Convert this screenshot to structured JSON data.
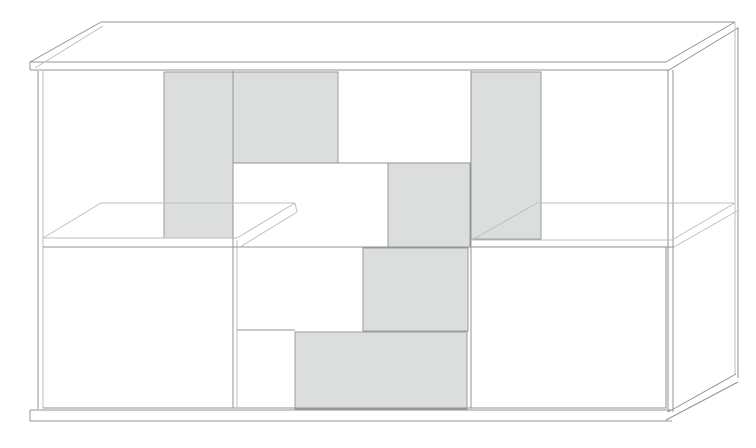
{
  "illustration": {
    "subject": "sideboard-cabinet-line-drawing",
    "style": "hidden-line technical render, white and gray patchwork door fronts"
  },
  "palette": {
    "background": "#ffffff",
    "panel_fill": "#dcdedd",
    "panel_border": "#989d9b",
    "line": "#8f9492",
    "line_light": "#bcc0be"
  },
  "drawing": {
    "width": 756,
    "height": 448,
    "top_surface": {
      "name": "top-slab-surface",
      "points": "30,62 666,62 735,22 101,22"
    },
    "panels": [
      {
        "name": "open-compartment-top-left",
        "x": 43,
        "y": 72,
        "w": 121,
        "h": 166,
        "fill": "none"
      },
      {
        "name": "glass-door-top-left",
        "x": 164,
        "y": 72,
        "w": 69,
        "h": 166,
        "fill": "gray"
      },
      {
        "name": "gray-door-top-center-left",
        "x": 233,
        "y": 72,
        "w": 105,
        "h": 91,
        "fill": "gray"
      },
      {
        "name": "white-door-top-center",
        "x": 338,
        "y": 72,
        "w": 133,
        "h": 91,
        "fill": "none"
      },
      {
        "name": "glass-door-top-right",
        "x": 471,
        "y": 72,
        "w": 70,
        "h": 167,
        "fill": "gray"
      },
      {
        "name": "open-compartment-top-right",
        "x": 541,
        "y": 72,
        "w": 124,
        "h": 168,
        "fill": "none"
      },
      {
        "name": "white-door-mid-center",
        "x": 233,
        "y": 163,
        "w": 155,
        "h": 84,
        "fill": "none"
      },
      {
        "name": "gray-door-mid-center-right",
        "x": 388,
        "y": 163,
        "w": 82,
        "h": 84,
        "fill": "gray"
      },
      {
        "name": "white-door-bottom-left",
        "x": 43,
        "y": 247,
        "w": 190,
        "h": 161,
        "fill": "none"
      },
      {
        "name": "white-door-center-upper",
        "x": 237,
        "y": 247,
        "w": 126,
        "h": 83,
        "fill": "none"
      },
      {
        "name": "white-door-center-small",
        "x": 237,
        "y": 330,
        "w": 58,
        "h": 78,
        "fill": "none"
      },
      {
        "name": "gray-door-center",
        "x": 363,
        "y": 248,
        "w": 105,
        "h": 83,
        "fill": "gray"
      },
      {
        "name": "gray-door-bottom-center",
        "x": 295,
        "y": 332,
        "w": 172,
        "h": 77,
        "fill": "gray"
      },
      {
        "name": "white-door-bottom-right",
        "x": 471,
        "y": 247,
        "w": 195,
        "h": 161,
        "fill": "none"
      }
    ],
    "lines": [
      {
        "name": "top-front-edge",
        "x1": 30,
        "y1": 62,
        "x2": 666,
        "y2": 62,
        "tone": "m"
      },
      {
        "name": "top-left-diagonal-outer",
        "x1": 30,
        "y1": 62,
        "x2": 101,
        "y2": 22,
        "tone": "m"
      },
      {
        "name": "top-left-diagonal-inner",
        "x1": 35,
        "y1": 68,
        "x2": 103,
        "y2": 26,
        "tone": "l"
      },
      {
        "name": "top-back-edge",
        "x1": 101,
        "y1": 22,
        "x2": 735,
        "y2": 22,
        "tone": "m"
      },
      {
        "name": "top-right-diagonal-outer",
        "x1": 666,
        "y1": 62,
        "x2": 735,
        "y2": 22,
        "tone": "m"
      },
      {
        "name": "top-slab-bottom-edge",
        "x1": 30,
        "y1": 70,
        "x2": 669,
        "y2": 70,
        "tone": "m"
      },
      {
        "name": "top-right-diagonal-inner",
        "x1": 669,
        "y1": 70,
        "x2": 738,
        "y2": 28,
        "tone": "m"
      },
      {
        "name": "top-slab-left-end",
        "x1": 30,
        "y1": 62,
        "x2": 30,
        "y2": 70,
        "tone": "m"
      },
      {
        "name": "back-right-vertical-inner",
        "x1": 735,
        "y1": 22,
        "x2": 735,
        "y2": 374,
        "tone": "l"
      },
      {
        "name": "back-right-vertical-outer",
        "x1": 738,
        "y1": 27,
        "x2": 738,
        "y2": 378,
        "tone": "m"
      },
      {
        "name": "side-bottom-diagonal",
        "x1": 668,
        "y1": 412,
        "x2": 736,
        "y2": 374,
        "tone": "m"
      },
      {
        "name": "plinth-right-diagonal",
        "x1": 666,
        "y1": 420,
        "x2": 738,
        "y2": 382,
        "tone": "m"
      },
      {
        "name": "front-right-vertical-inner",
        "x1": 668,
        "y1": 70,
        "x2": 668,
        "y2": 412,
        "tone": "m"
      },
      {
        "name": "front-right-vertical-outer",
        "x1": 673,
        "y1": 70,
        "x2": 673,
        "y2": 412,
        "tone": "m"
      },
      {
        "name": "left-vertical-outer",
        "x1": 38,
        "y1": 71,
        "x2": 38,
        "y2": 409,
        "tone": "m"
      },
      {
        "name": "left-vertical-inner",
        "x1": 43,
        "y1": 71,
        "x2": 43,
        "y2": 408,
        "tone": "l"
      },
      {
        "name": "plinth-top-edge",
        "x1": 30,
        "y1": 410,
        "x2": 672,
        "y2": 410,
        "tone": "m"
      },
      {
        "name": "plinth-bottom-edge",
        "x1": 30,
        "y1": 421,
        "x2": 672,
        "y2": 421,
        "tone": "m"
      },
      {
        "name": "plinth-left-end",
        "x1": 30,
        "y1": 410,
        "x2": 30,
        "y2": 421,
        "tone": "m"
      },
      {
        "name": "door-bottom-line",
        "x1": 43,
        "y1": 408,
        "x2": 666,
        "y2": 408,
        "tone": "m"
      },
      {
        "name": "divider-vertical-left",
        "x1": 233,
        "y1": 71,
        "x2": 233,
        "y2": 408,
        "tone": "m"
      },
      {
        "name": "divider-vertical-left-gap",
        "x1": 237,
        "y1": 240,
        "x2": 237,
        "y2": 408,
        "tone": "l"
      },
      {
        "name": "divider-vertical-right",
        "x1": 471,
        "y1": 71,
        "x2": 471,
        "y2": 408,
        "tone": "m"
      },
      {
        "name": "divider-horizontal-upper",
        "x1": 233,
        "y1": 163,
        "x2": 471,
        "y2": 163,
        "tone": "m"
      },
      {
        "name": "divider-horizontal-small",
        "x1": 237,
        "y1": 330,
        "x2": 295,
        "y2": 330,
        "tone": "m"
      },
      {
        "name": "right-door-right-edge",
        "x1": 666,
        "y1": 247,
        "x2": 666,
        "y2": 408,
        "tone": "m"
      },
      {
        "name": "shelf-front-top-left",
        "x1": 43,
        "y1": 238,
        "x2": 237,
        "y2": 238,
        "tone": "l"
      },
      {
        "name": "shelf-front-top-right",
        "x1": 472,
        "y1": 240,
        "x2": 672,
        "y2": 240,
        "tone": "l"
      },
      {
        "name": "mid-divider-line",
        "x1": 43,
        "y1": 247,
        "x2": 674,
        "y2": 247,
        "tone": "m"
      },
      {
        "name": "shelf-left-back-edge",
        "x1": 101,
        "y1": 203,
        "x2": 295,
        "y2": 203,
        "tone": "l"
      },
      {
        "name": "shelf-left-end-diagonal",
        "x1": 43,
        "y1": 238,
        "x2": 101,
        "y2": 203,
        "tone": "l"
      },
      {
        "name": "shelf-left-cap-top",
        "x1": 237,
        "y1": 238,
        "x2": 295,
        "y2": 203,
        "tone": "l"
      },
      {
        "name": "shelf-left-cap-bottom",
        "x1": 240,
        "y1": 247,
        "x2": 297,
        "y2": 212,
        "tone": "l"
      },
      {
        "name": "shelf-left-cap-end",
        "x1": 295,
        "y1": 203,
        "x2": 297,
        "y2": 212,
        "tone": "l"
      },
      {
        "name": "shelf-right-back-edge",
        "x1": 537,
        "y1": 203,
        "x2": 734,
        "y2": 203,
        "tone": "l"
      },
      {
        "name": "shelf-right-end-diagonal",
        "x1": 472,
        "y1": 240,
        "x2": 537,
        "y2": 203,
        "tone": "l"
      },
      {
        "name": "shelf-right-cap-top",
        "x1": 672,
        "y1": 240,
        "x2": 735,
        "y2": 203,
        "tone": "l"
      },
      {
        "name": "shelf-right-cap-bottom",
        "x1": 674,
        "y1": 247,
        "x2": 737,
        "y2": 211,
        "tone": "l"
      }
    ]
  }
}
